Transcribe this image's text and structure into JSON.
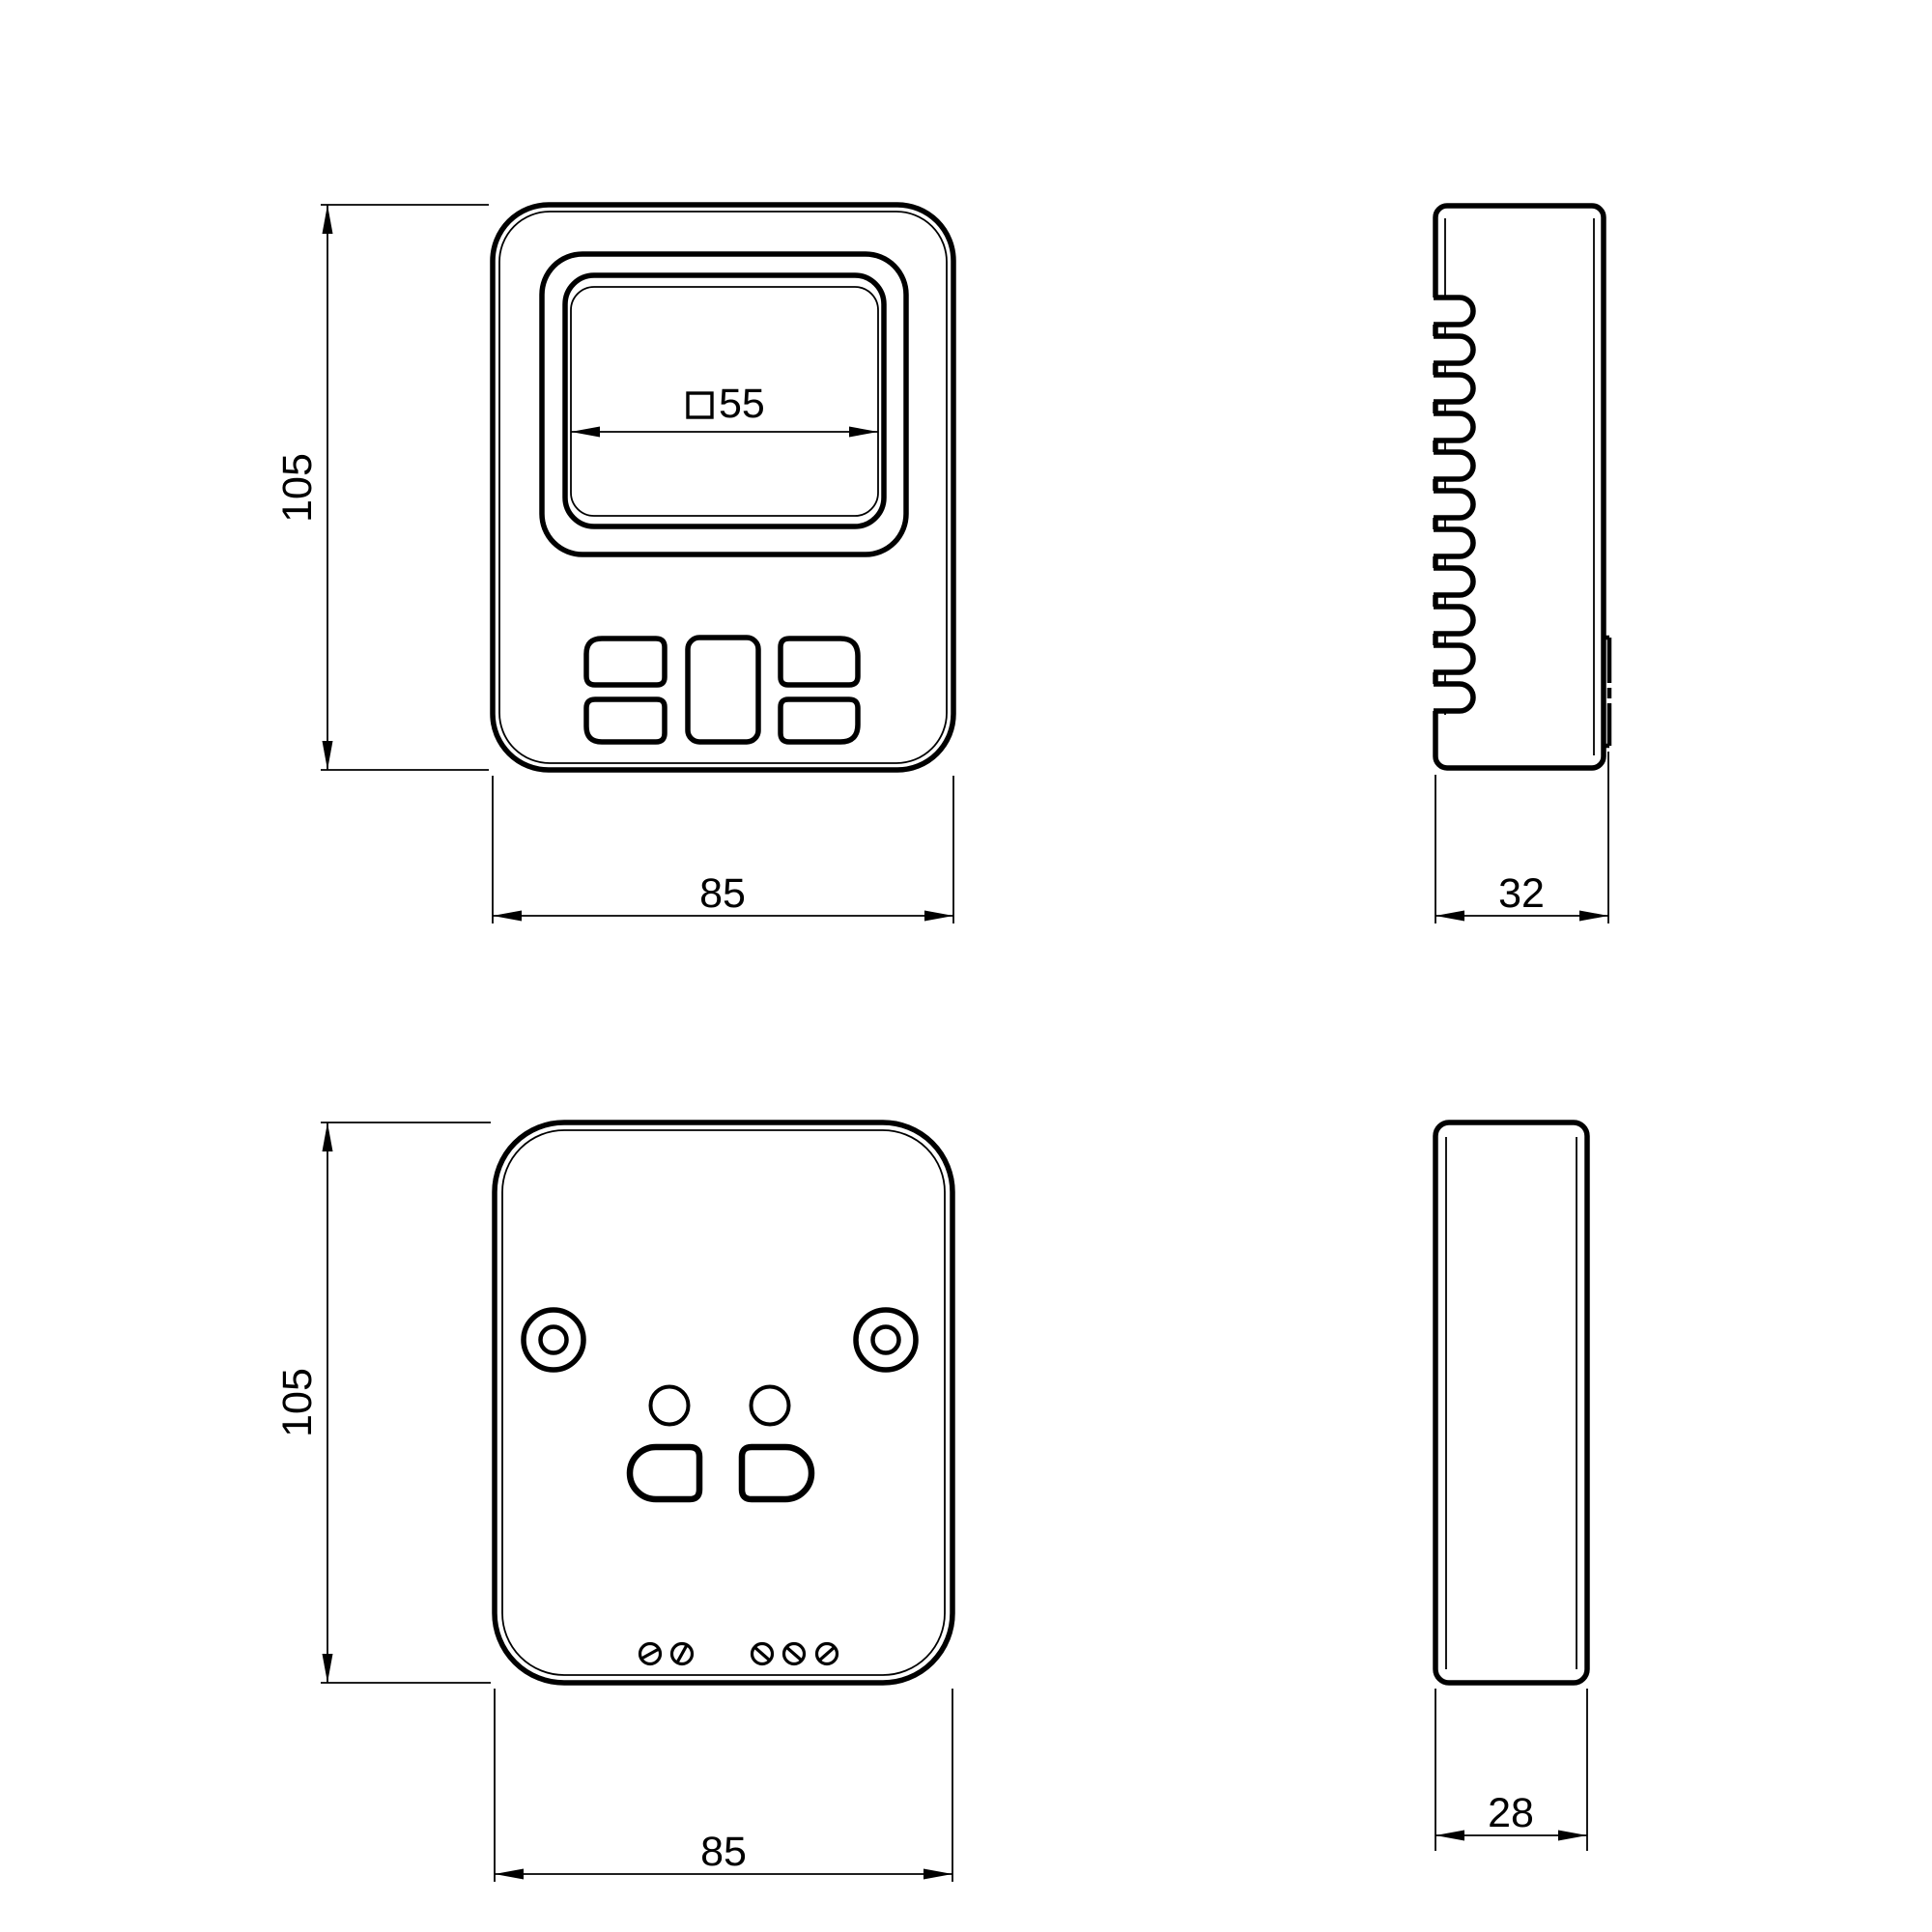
{
  "drawing": {
    "background_color": "#ffffff",
    "line_color": "#000000",
    "front_view": {
      "height_dim": "105",
      "width_dim": "85",
      "cutout_dim": "55",
      "cutout_symbol": "square"
    },
    "right_side_view": {
      "depth_dim": "32"
    },
    "back_view": {
      "height_dim": "105",
      "width_dim": "85"
    },
    "profile_view": {
      "depth_dim": "28"
    }
  }
}
